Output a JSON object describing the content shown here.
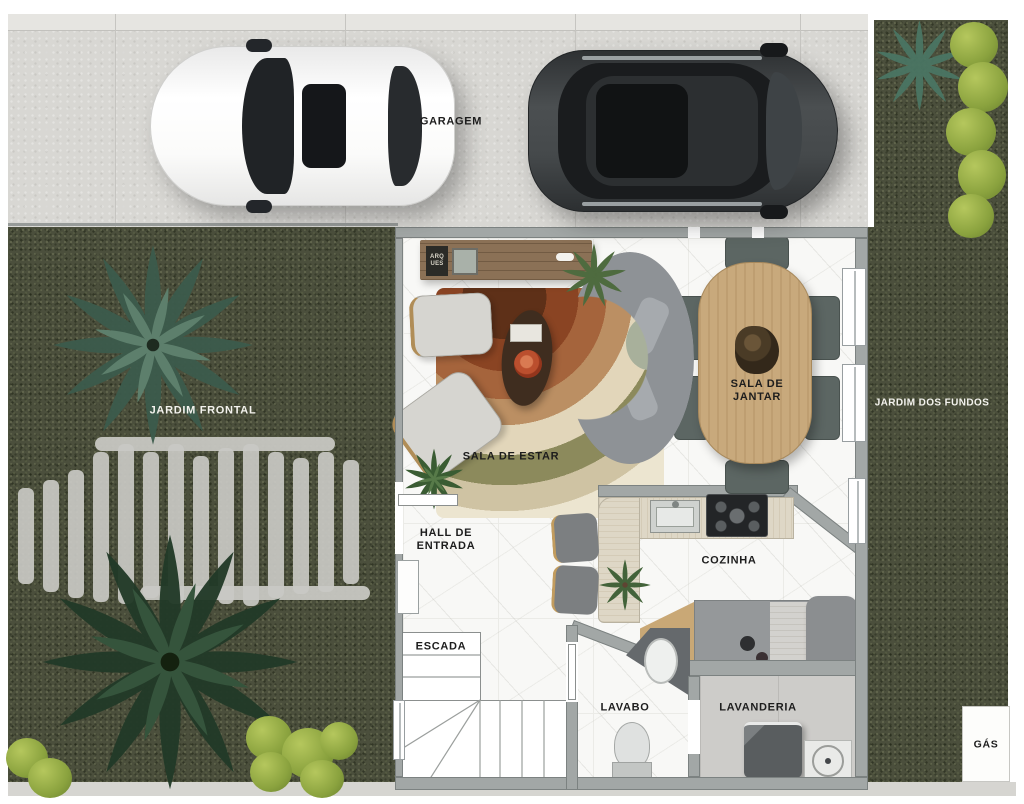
{
  "plan": {
    "areas": {
      "garagem": {
        "label": "GARAGEM"
      },
      "jardim_frontal": {
        "label": "JARDIM FRONTAL"
      },
      "jardim_dos_fundos": {
        "label": "JARDIM DOS FUNDOS"
      },
      "sala_de_estar": {
        "label": "SALA DE ESTAR"
      },
      "sala_de_jantar": {
        "line1": "SALA DE",
        "line2": "JANTAR"
      },
      "hall_de_entrada": {
        "line1": "HALL DE",
        "line2": "ENTRADA"
      },
      "cozinha": {
        "label": "COZINHA"
      },
      "escada": {
        "label": "ESCADA"
      },
      "lavabo": {
        "label": "LAVABO"
      },
      "lavanderia": {
        "label": "LAVANDERIA"
      },
      "gas": {
        "label": "GÁS"
      }
    },
    "decor": {
      "sideboard_plaque": {
        "line1": "ARQ",
        "line2": "UES"
      }
    },
    "palette": {
      "grass": "#4b4f3c",
      "pavement": "#d8d7d3",
      "marble_floor": "#f8f8f6",
      "wall_gray": "#a2a7a6",
      "dining_table_wood": "#c8a97c",
      "credenza_wood": "#8b7156",
      "sofa_gray": "#8e9296",
      "rug_terracotta": "#8a4423",
      "shrub_green": "#9db14c",
      "laundry_floor": "#cdccc9",
      "dark_car": "#3a3d3f",
      "white_car": "#f7f7f7"
    }
  }
}
